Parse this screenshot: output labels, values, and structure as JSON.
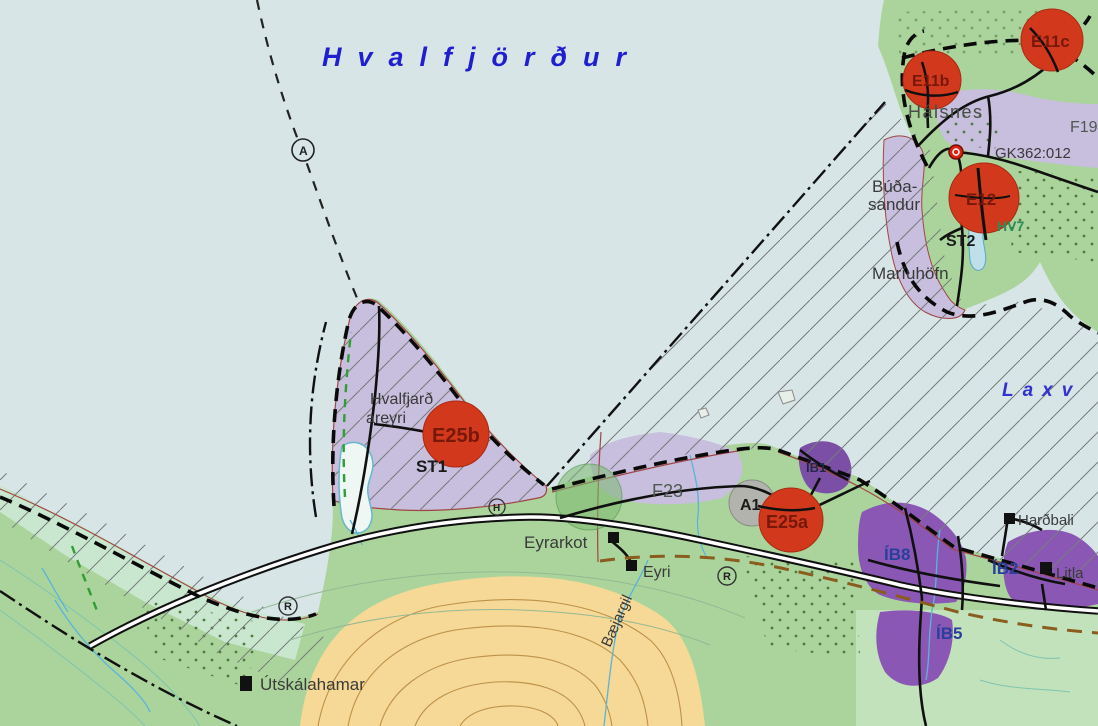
{
  "map": {
    "title": "Hvalfjörður",
    "water_labels": {
      "fjord": "Hvalfjörður",
      "laxvogur_partial": "Laxv"
    },
    "place_labels": {
      "halsnes": "Hálsnes",
      "budasandur_line1": "Búða-",
      "budasandur_line2": "sandur",
      "mariuhofn": "Maríuhöfn",
      "hvalfjardareyri_line1": "Hvalfjarð",
      "hvalfjardareyri_line2": "areyri",
      "eyrarkot": "Eyrarkot",
      "eyri": "Eyri",
      "baejargil": "Bæjargil",
      "utskalahamar": "Útskálahamar",
      "hardbali": "Harðbali",
      "litla": "Litla",
      "gk_parcel": "GK362:012"
    },
    "zone_labels": {
      "e11b": "E11b",
      "e11c": "E11c",
      "e12": "E12",
      "e25b": "E25b",
      "e25a": "E25a",
      "a1": "A1",
      "st1": "ST1",
      "st2": "ST2",
      "hv7": "HV7",
      "f19": "F19",
      "f23": "F23",
      "ib1": "ÍB1",
      "ib2": "ÍB2",
      "ib5": "ÍB5",
      "ib8": "ÍB8"
    },
    "symbol_letters": {
      "circled_a": "A",
      "circled_r1": "R",
      "circled_r2": "R",
      "circled_h": "H"
    },
    "colors": {
      "sea": "#d7e5e7",
      "land_green": "#abd49c",
      "pale_coast_green": "#c9e7ce",
      "lavender_zone": "#c8bedd",
      "purple_residential": "#8b57b5",
      "purple_dark_blob": "#7b4fa6",
      "yellow_hill": "#f6d996",
      "red_zone_circle": "#d2391c",
      "gray_zone_circle": "#b3b3ae",
      "green_zone_circle": "#7ab86f",
      "road_casing": "#101010",
      "road_fill": "#ffffff",
      "title_blue": "#1f1fd0",
      "label_blue": "#28409c",
      "maroon_label": "#76180a",
      "brown_trail": "#8a5c1e",
      "green_trail": "#2f9e33",
      "stream_blue": "#5ab4d8",
      "contour_tan": "#bd9148"
    }
  }
}
